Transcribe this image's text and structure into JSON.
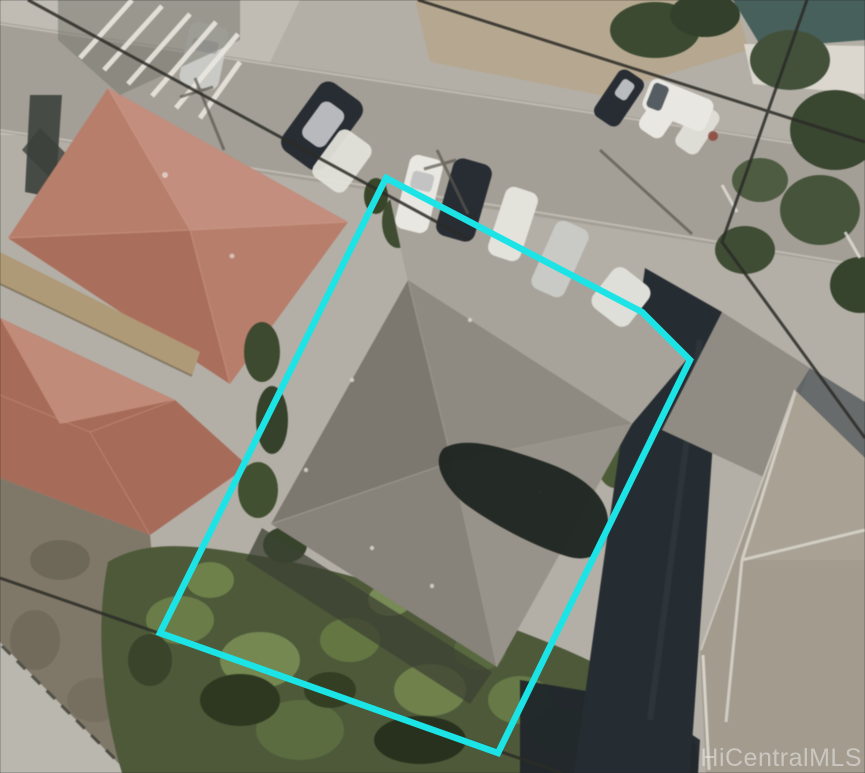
{
  "watermark": {
    "text": "HiCentralMLS",
    "color": "#ebebeb",
    "opacity": "0.55"
  },
  "boundary": {
    "color": "#1ce4e6",
    "width": "6.5"
  },
  "colors": {
    "base_pavement": "#b3afa6",
    "pavement_light": "#c0bcb3",
    "street": "#a49f96",
    "curb": "#c9c6be",
    "dirt_tan": "#b7a88f",
    "teal_roof": "#47605c",
    "white_path": "#dcd7cd",
    "tree_green": "#3c4a31",
    "red_roof": "#b97d6a",
    "red_roof_light": "#c78f7e",
    "red_roof_dark": "#aa6a57",
    "walkway_tan": "#b09a76",
    "ground_olive": "#7f7867",
    "corner_concrete": "#bab7af",
    "vegetation": "#4d5938",
    "vegetation_light": "#74894c",
    "vegetation_dark": "#2e381f",
    "dark_roof": "#262d32",
    "neighbor_roof": "#a29b8d",
    "neighbor_roof_light": "#aba496",
    "neighbor_ridge": "#d7d3c9",
    "subject_roof_nw": "#7d786e",
    "subject_roof_ne": "#8f8a80",
    "subject_roof_se": "#98938a",
    "subject_roof_sw": "#87827a",
    "subject_ridge": "#9b968c",
    "roof_blob_shadow": "#1d2420",
    "house_shadow": "#3c4232",
    "car_white": "#e8e7e1",
    "car_dark": "#282d33",
    "car_silver": "#c9cac5",
    "power_line": "#2b2b27",
    "pole_shadow": "#5b574f",
    "mid_gray_drive": "#908c84",
    "dark_drive": "#5b5f61"
  }
}
